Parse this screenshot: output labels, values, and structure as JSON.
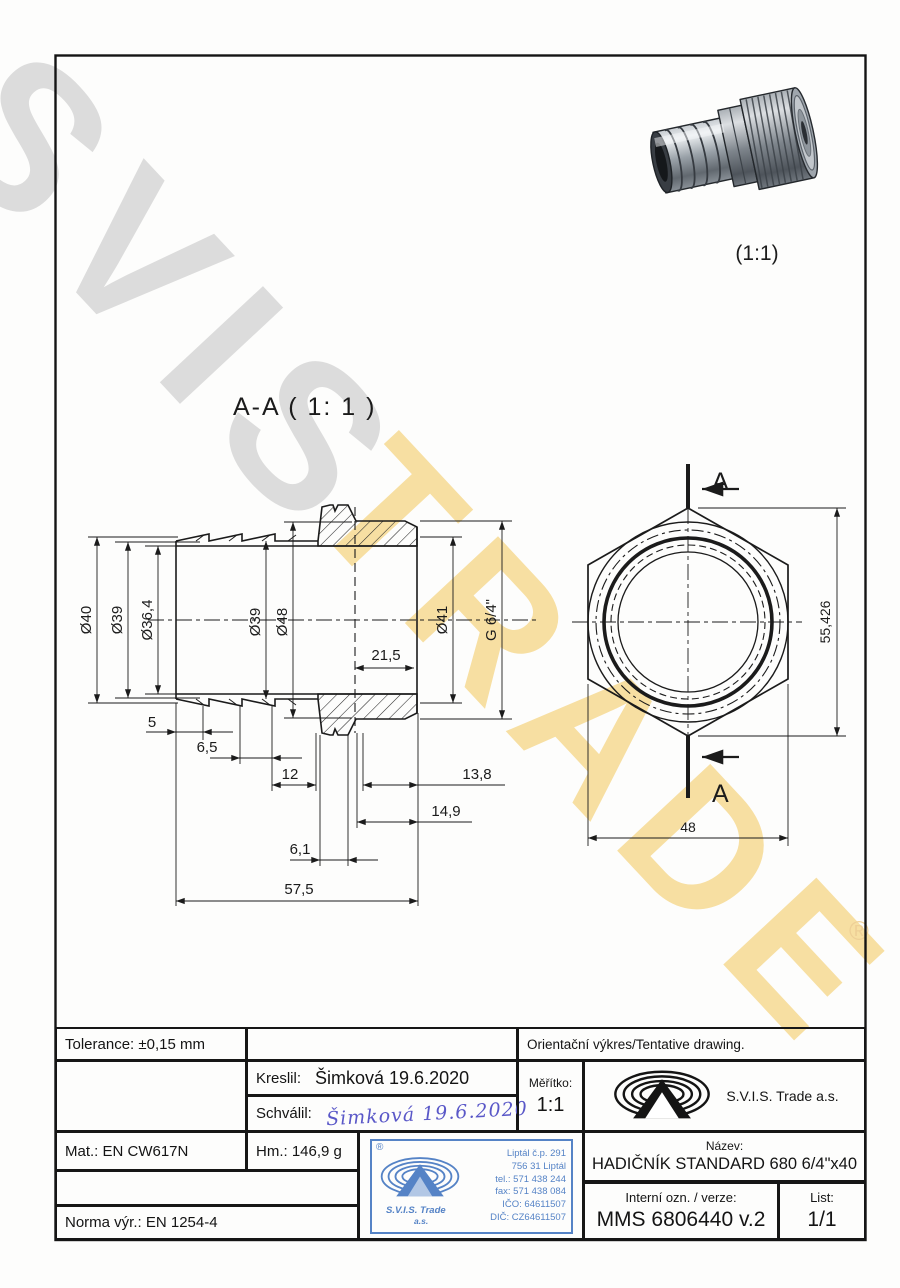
{
  "watermark": {
    "line1": "SVIS",
    "line2": "TRADE",
    "registered": "®"
  },
  "photo": {
    "caption": "(1:1)"
  },
  "drawing": {
    "section_label": "A-A ( 1: 1 )",
    "dims": {
      "d40": "Ø40",
      "d39_left": "Ø39",
      "d36_4": "Ø36,4",
      "d39_mid": "Ø39",
      "d48": "Ø48",
      "len21_5": "21,5",
      "d41": "Ø41",
      "g64": "G 6/4\"",
      "len5": "5",
      "len6_5": "6,5",
      "len12": "12",
      "len13_8": "13,8",
      "len14_9": "14,9",
      "len6_1": "6,1",
      "len57_5": "57,5",
      "hex_corner": "55,426",
      "hex_flat": "48",
      "sec_a_top": "A",
      "sec_a_bottom": "A"
    }
  },
  "titleblock": {
    "tolerance": "Tolerance: ±0,15 mm",
    "orientacni": "Orientační výkres/Tentative drawing.",
    "kreslil_label": "Kreslil:",
    "kreslil_value": "Šimková 19.6.2020",
    "schvalil_label": "Schválil:",
    "schvalil_signature": "Šimková 19.6.2020",
    "meritko_label": "Měřítko:",
    "meritko_value": "1:1",
    "company": "S.V.I.S. Trade a.s.",
    "mat": "Mat.: EN CW617N",
    "hm": "Hm.: 146,9 g",
    "norma": "Norma výr.: EN 1254-4",
    "nazev_label": "Název:",
    "nazev_value": "HADIČNÍK STANDARD 680 6/4\"x40",
    "interni_label": "Interní ozn. / verze:",
    "interni_value": "MMS 6806440 v.2",
    "list_label": "List:",
    "list_value": "1/1"
  },
  "stamp": {
    "registered": "®",
    "line1": "Liptál č.p. 291",
    "line2": "756 31 Liptál",
    "line3": "tel.: 571 438 244",
    "line4": "fax: 571 438 084",
    "line5": "IČO: 64611507",
    "line6": "DIČ: CZ64611507",
    "company1": "S.V.I.S. Trade",
    "company2": "a.s."
  }
}
